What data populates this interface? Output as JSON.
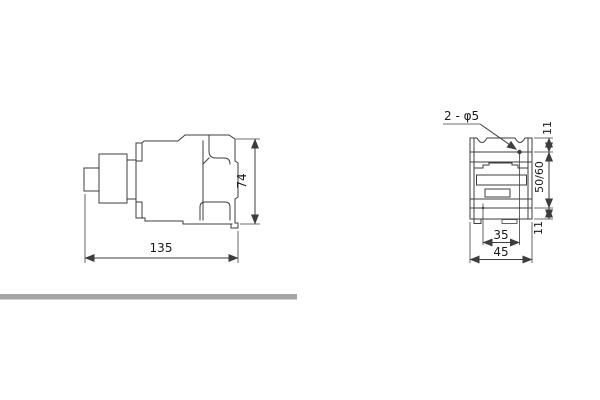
{
  "figure": {
    "kind": "contactor-dimension-drawing",
    "side_view": {
      "width_label": "135",
      "height_label": "74"
    },
    "front_view": {
      "holes_callout": "2 - φ5",
      "top_offset_label": "11",
      "rail_span_label": "50/60",
      "bottom_offset_label": "11",
      "hole_spacing_label": "35",
      "width_label": "45"
    }
  },
  "colors": {
    "line": "#3d3d3d",
    "text": "#1a1a1a",
    "bottom_bar": "#a6a6a6",
    "shaded_tab": "#b3b3b3"
  }
}
